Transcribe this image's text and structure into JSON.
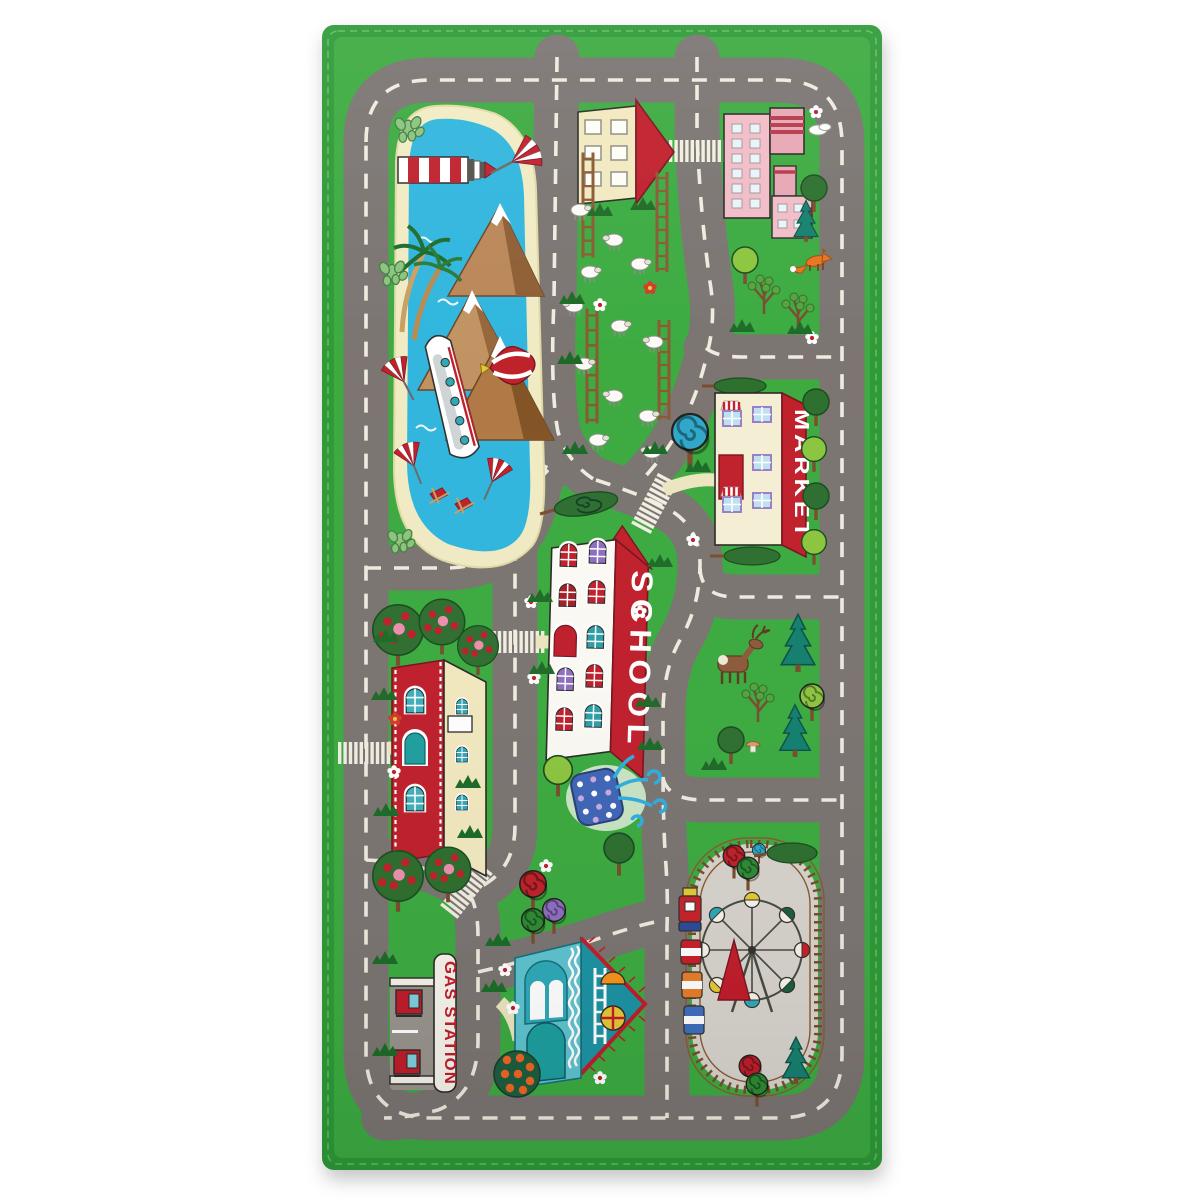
{
  "scene": {
    "description": "Photograph of a children's city roadway play rug lying flat on a white background",
    "background_color": "#ffffff"
  },
  "rug": {
    "labels": {
      "school": "SCHOOL",
      "market": "MARKET",
      "gas_station": "GAS STATION"
    },
    "palette": {
      "grass_green": "#3CAB41",
      "hem_green": "#2F9A38",
      "road_gray": "#7B7572",
      "road_dash": "#F0EBDF",
      "water_blue": "#31B6DE",
      "sand_cream": "#F1EBC4",
      "signal_red": "#C0202C",
      "factory_pink": "#F2BCC8",
      "house_teal": "#2FA9B8",
      "tree_green": "#2E6F2F",
      "pine_teal": "#17806F",
      "track_brown": "#7A4E2E",
      "park_gray": "#D8D4CD"
    },
    "landmarks": [
      "lake with lighthouse, cruise ship, sailboats and hot-air balloon",
      "mountain peaks with snow caps",
      "palm trees, cactus and beach chairs",
      "sheep pasture with wooden fences and farm house",
      "pink factory with smoking chimneys",
      "fox and forest with moose, pines and mushrooms",
      "market building with striped awnings",
      "school building with arched windows and fountain",
      "red house with apple trees",
      "gas station with two fuel pumps",
      "teal cottage with ladder and round window",
      "amusement park with ferris wheel, red spire and circus train loop",
      "ring road with dashed lane markings and zebra crossings"
    ]
  }
}
